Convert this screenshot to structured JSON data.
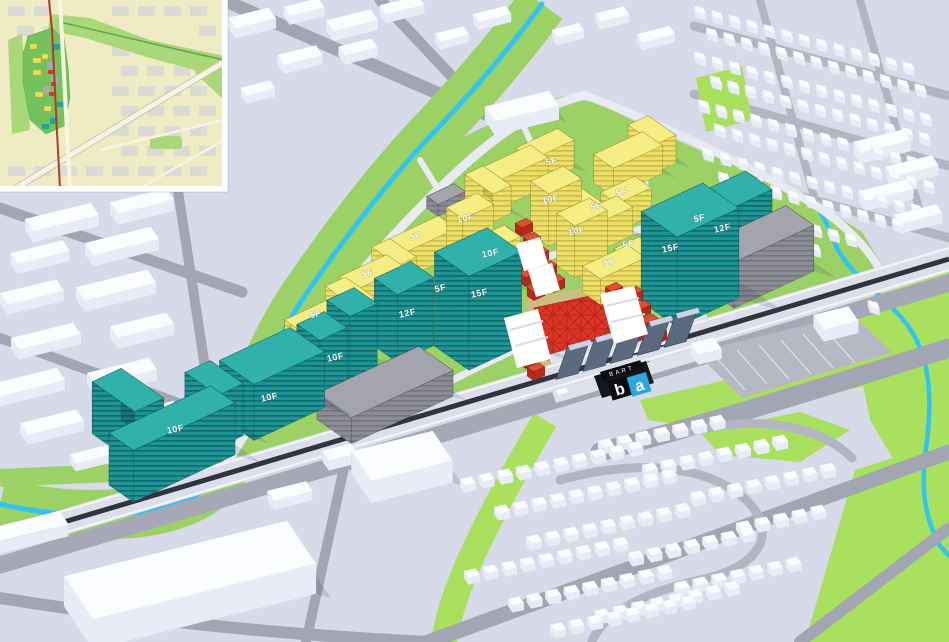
{
  "building_labels": [
    "10F",
    "10F",
    "10F",
    "12F",
    "15F",
    "15F",
    "12F",
    "5F",
    "5F",
    "5F",
    "5F",
    "10F",
    "10F",
    "5F",
    "10F",
    "5F",
    "5F",
    "10F",
    "5F",
    "5F",
    "5F"
  ],
  "station": {
    "brand": "BART",
    "logo_b": "b",
    "logo_a": "a"
  },
  "colors": {
    "ground": "#D7DAE9",
    "road": "#A2A5B2",
    "road_light": "#B3B6C2",
    "site_green": "#9CD166",
    "lawn_green": "#A9E05E",
    "creek": "#2FC4F1",
    "office_teal_top": "#30B2AA",
    "residential_yellow_top": "#F4EE84",
    "retail_red": "#E2462F",
    "existing_gray_top": "#A3A4AC",
    "context_white": "#FBFCFF",
    "context_shade_blue": "#8CA3D4",
    "rail_dark": "#2F3540",
    "plaza_red": "#DE3426",
    "logo_blue": "#2AA7DF",
    "logo_black": "#0B0D12",
    "inset_cream": "#EFECC3",
    "inset_site_green": "#74C25C",
    "inset_corridor_green": "#A9D77A",
    "inset_transit_red": "#B5382C"
  }
}
